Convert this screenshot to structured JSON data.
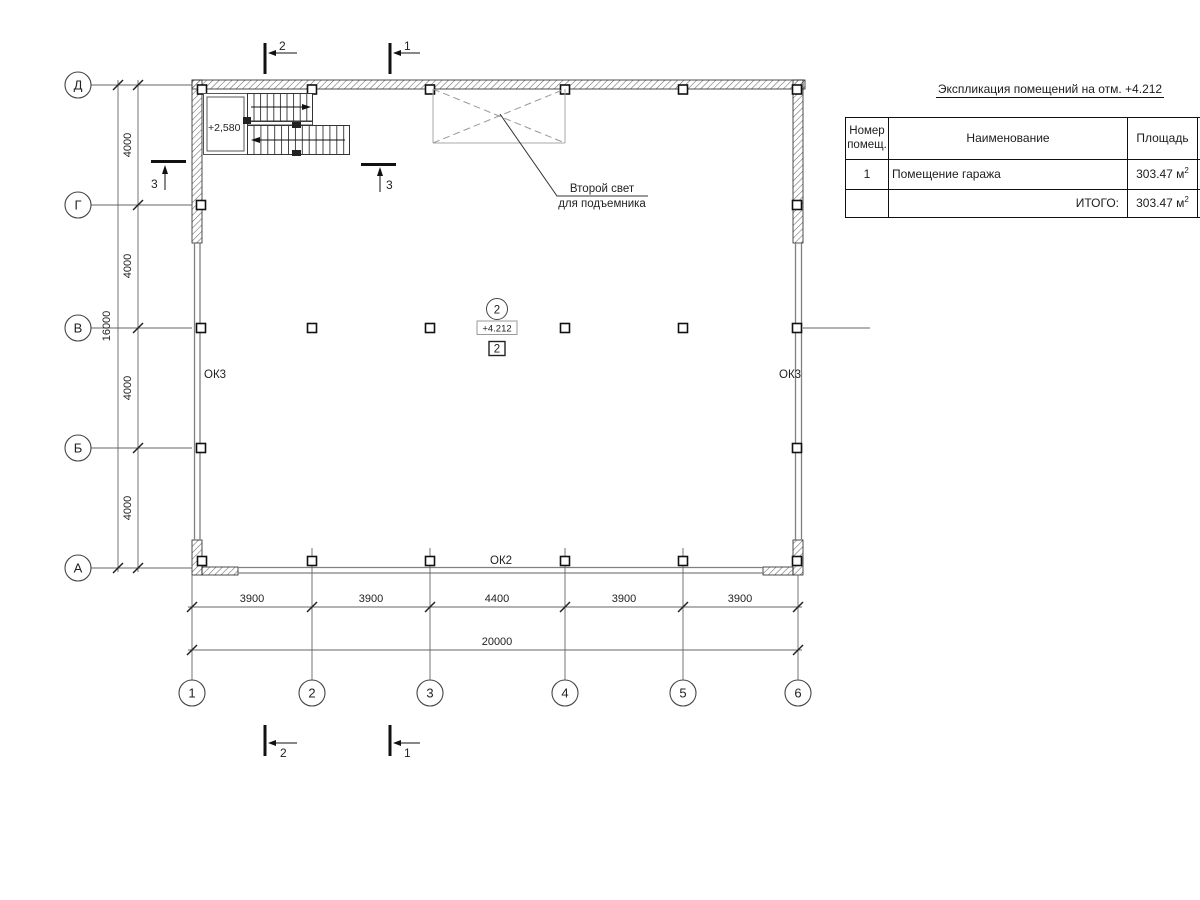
{
  "title": "Экспликация помещений на отм. +4.212",
  "table": {
    "headers": {
      "num1": "Номер",
      "num2": "помещ.",
      "name": "Наименование",
      "area": "Площадь",
      "extra1": "К",
      "extra2": "п"
    },
    "row": {
      "num": "1",
      "name": "Помещение гаража",
      "area": "303.47 м",
      "area_sup": "2"
    },
    "total": {
      "label": "ИТОГО:",
      "area": "303.47 м",
      "area_sup": "2"
    }
  },
  "grid": {
    "rows": [
      "Д",
      "Г",
      "В",
      "Б",
      "А"
    ],
    "cols": [
      "1",
      "2",
      "3",
      "4",
      "5",
      "6"
    ]
  },
  "dims": {
    "left": [
      "4000",
      "4000",
      "4000",
      "4000"
    ],
    "left_total": "16000",
    "bottom": [
      "3900",
      "3900",
      "4400",
      "3900",
      "3900"
    ],
    "bottom_total": "20000"
  },
  "labels": {
    "stairs_level": "+2,580",
    "floor_level": "+4.212",
    "room_circle": "2",
    "room_square": "2",
    "window_left": "ОК3",
    "window_right": "ОК3",
    "window_bottom": "ОК2",
    "note1": "Второй свет",
    "note2": "для подъемника"
  },
  "sections": {
    "top_left": "2",
    "top_right": "1",
    "bottom_left": "2",
    "bottom_right": "1",
    "side_left": "3",
    "side_inner": "3"
  },
  "colors": {
    "line": "#333333",
    "hatch": "#666666",
    "thin_wall": "#808080",
    "dashed": "#999999"
  }
}
